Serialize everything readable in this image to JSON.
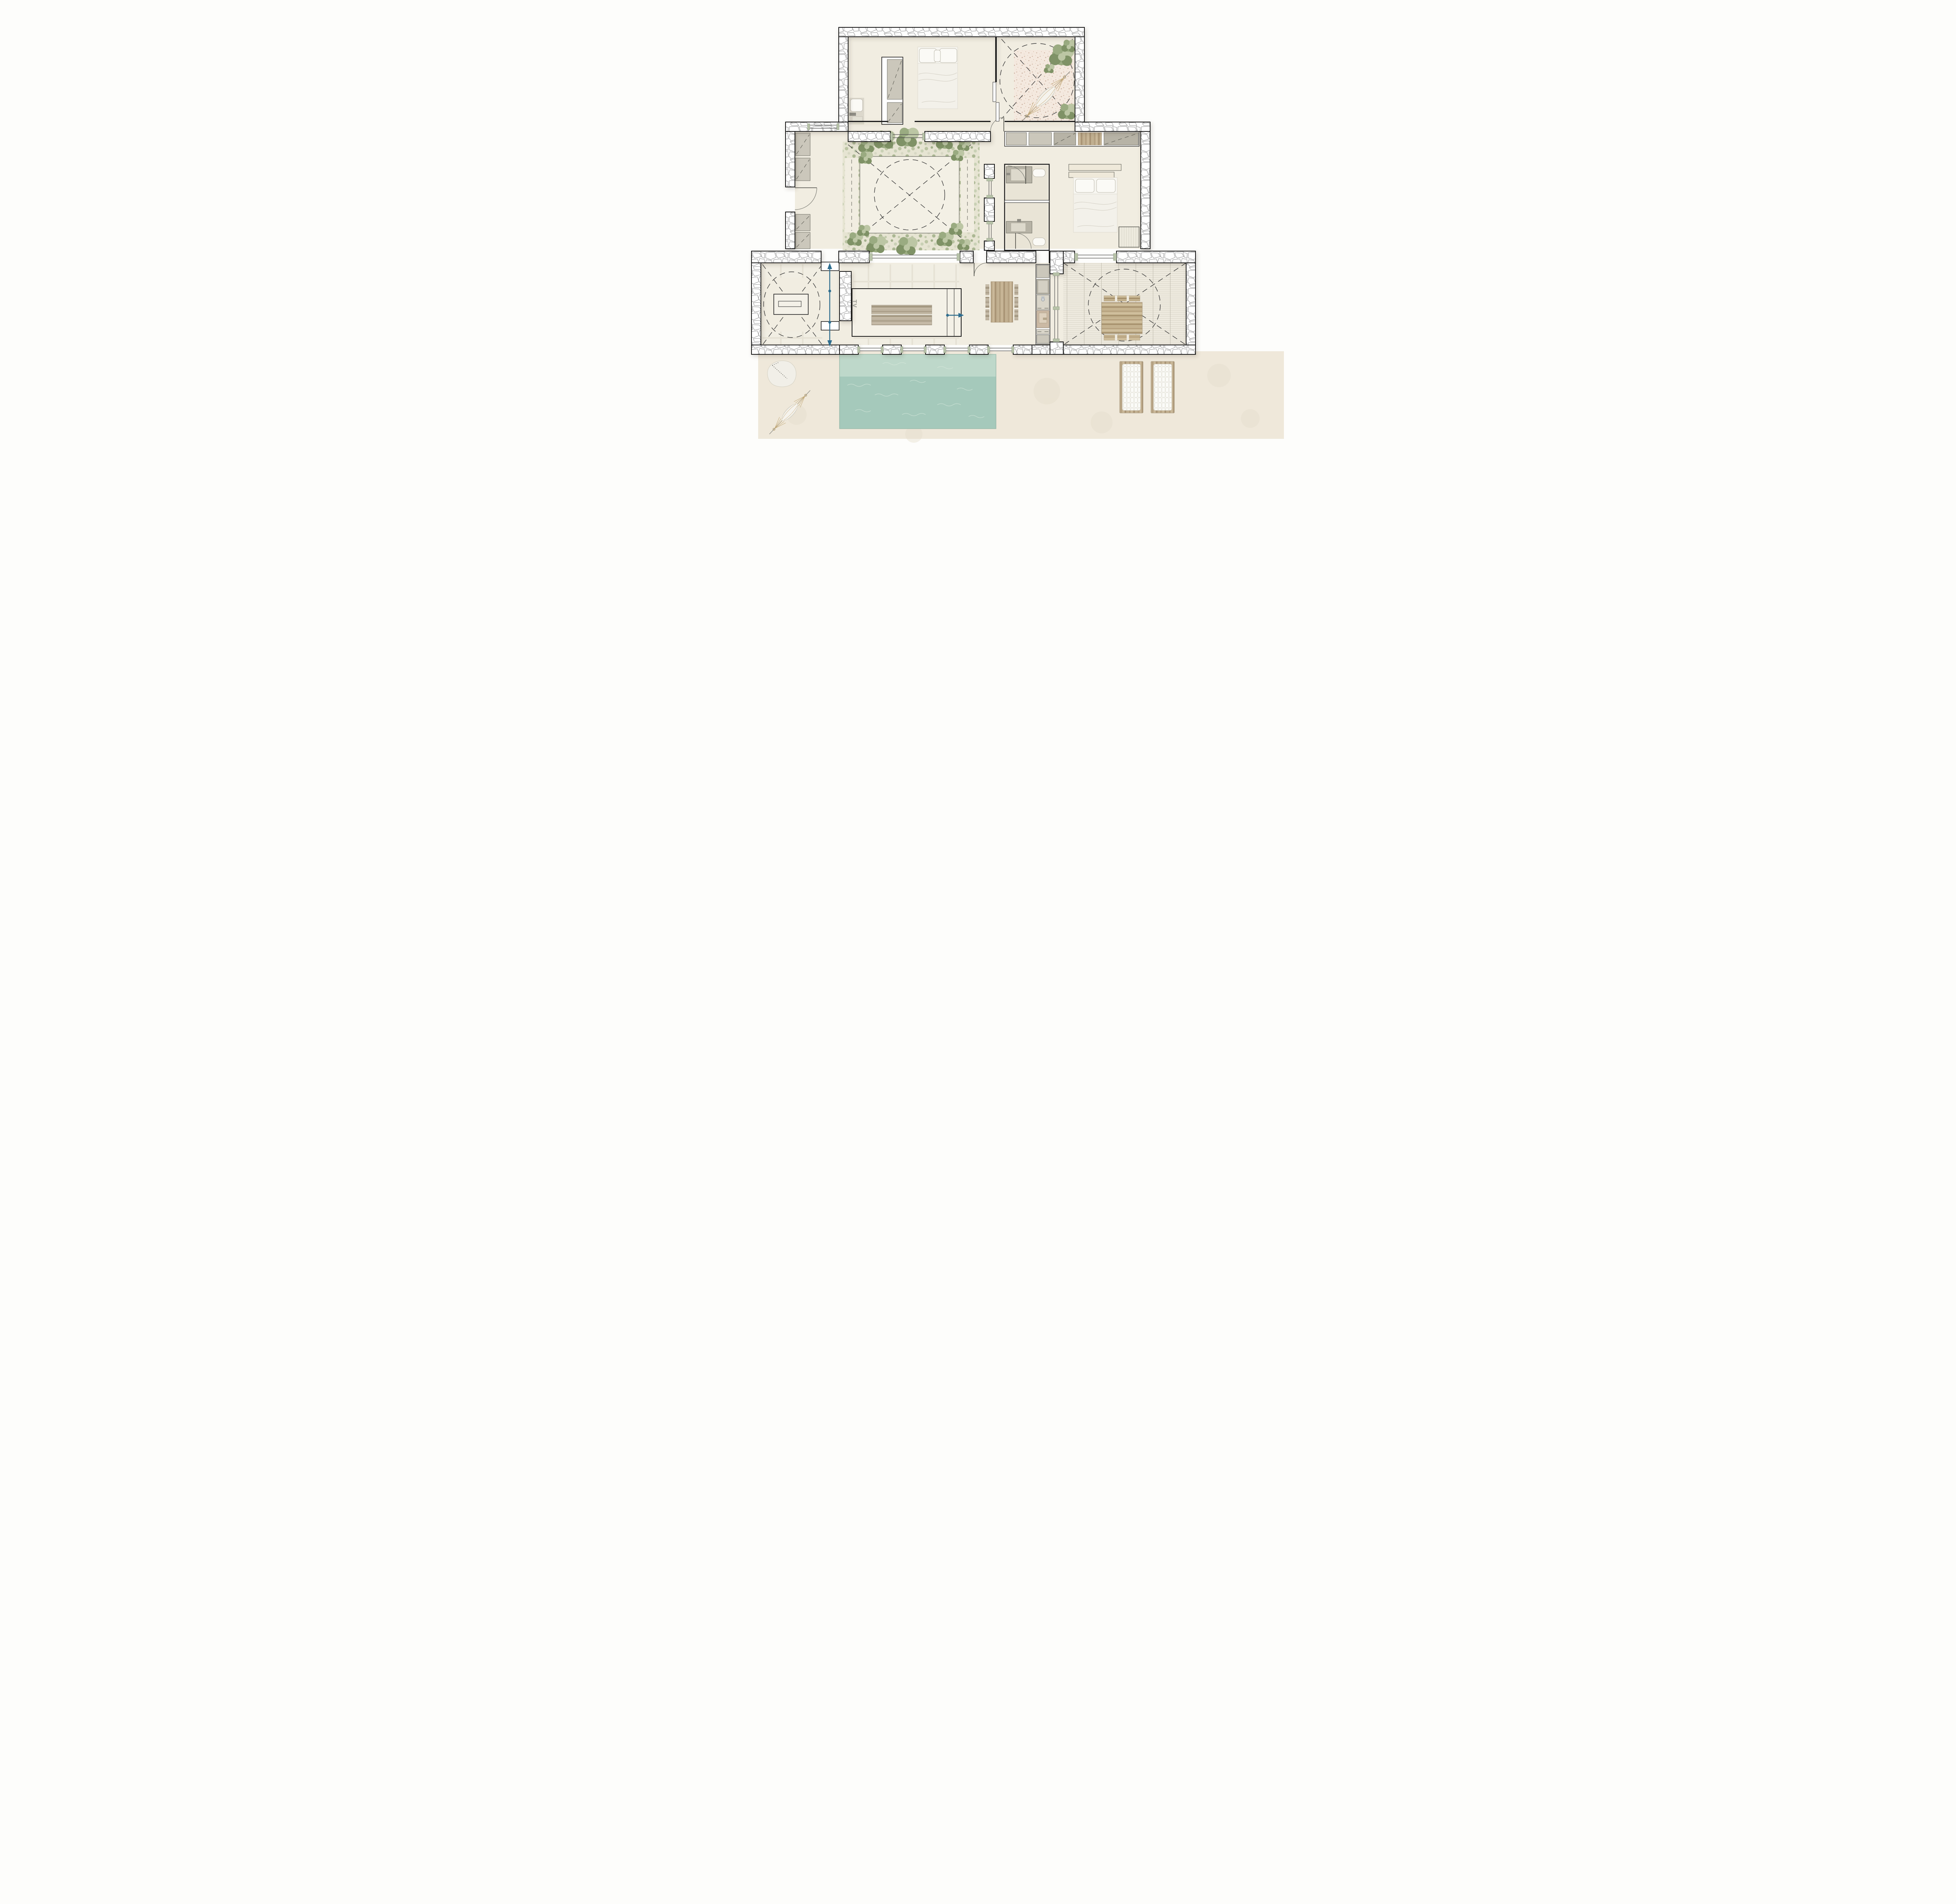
{
  "labels": {
    "tv": "TV"
  },
  "colors": {
    "paper": "#fdfdfb",
    "floor": "#f1ede1",
    "floor_shade": "#e9e4d6",
    "wall_line": "#1b1b1b",
    "stone_line": "#8f8f8f",
    "sand": "#efe8da",
    "gravel": "#f4e9df",
    "gravel_dot": "#d3b7a5",
    "planting": "#e6e4d2",
    "leaf_dark": "#7f9266",
    "leaf_mid": "#9aab81",
    "leaf_light": "#bcc6a4",
    "pool_shallow": "#bed8ca",
    "pool_deep": "#a5c9bb",
    "ripple": "#dcebdf",
    "wood_mid": "#b7a384",
    "wood_grey": "#b8ad99",
    "cabinet": "#cbc7bb",
    "cabinet_dark": "#b7b3a6",
    "glass": "#4f4f4f",
    "sill": "#b7c2a8",
    "accent": "#2e6d8e",
    "dash_line": "#3c3c3c",
    "tv": "#9c9c94",
    "cushion": "#fbfbf8",
    "tile_line": "#e2decf",
    "outline_soft": "#85857d"
  }
}
